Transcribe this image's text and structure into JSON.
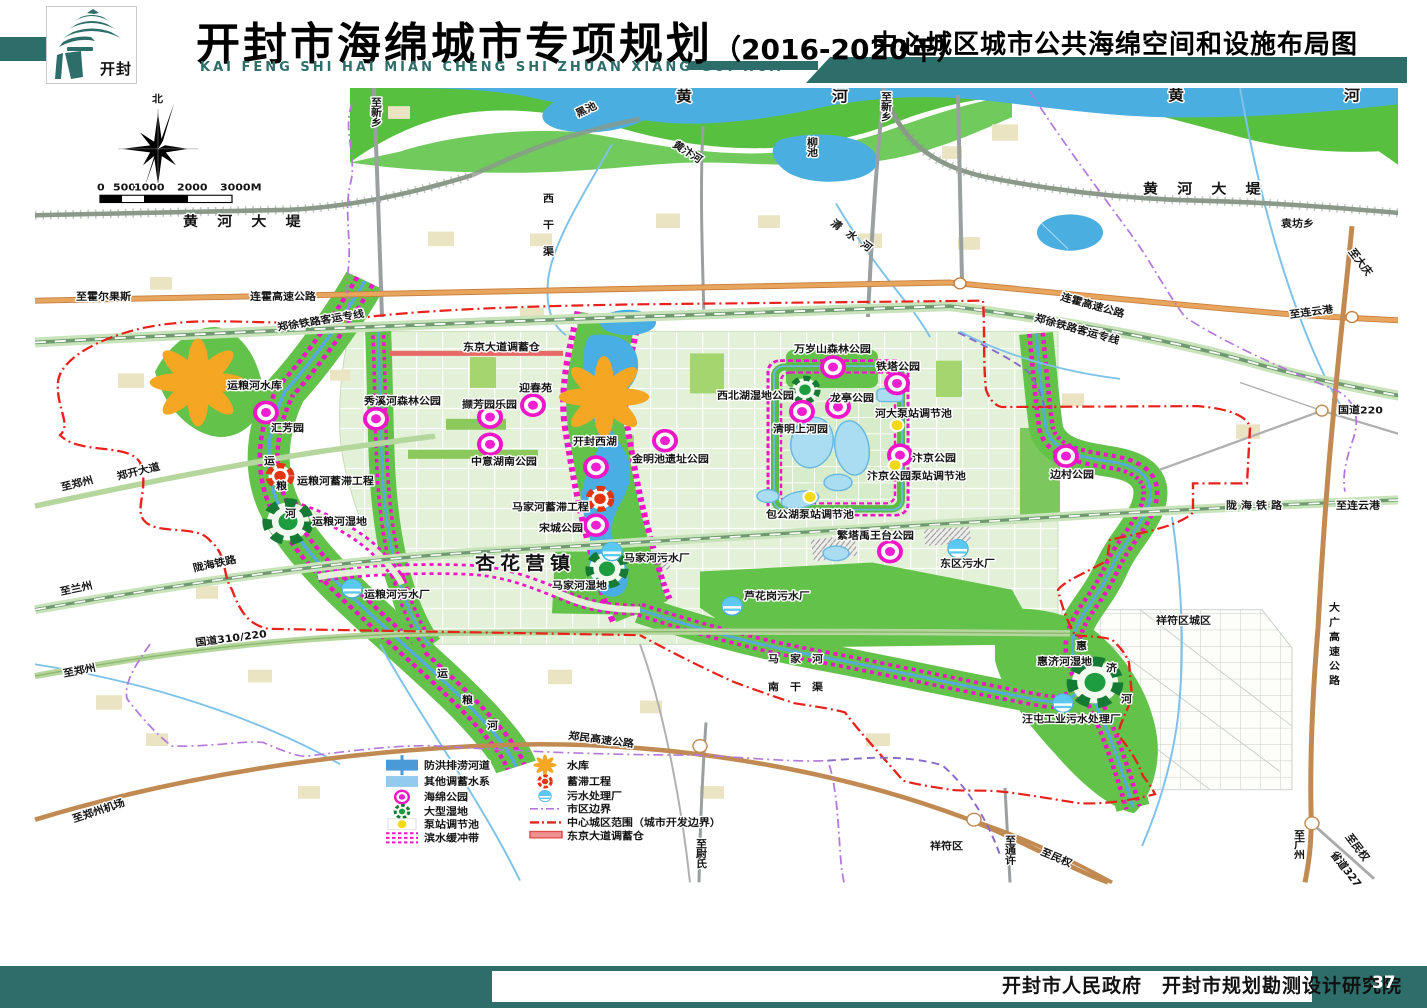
{
  "header": {
    "title": "开封市海绵城市专项规划",
    "title_year": "（2016-2020年）",
    "pinyin": "KAI FENG SHI HAI MIAN CHENG SHI ZHUAN XIANG GUI HUA",
    "subtitle": "中心城区城市公共海绵空间和设施布局图",
    "logo_seal": "开封"
  },
  "footer": {
    "credit": "开封市人民政府　开封市规划勘测设计研究院",
    "page": "37"
  },
  "compass": {
    "north": "北"
  },
  "scale_bar": {
    "labels": [
      "0",
      "500",
      "1000",
      "2000",
      "3000M"
    ]
  },
  "legend": {
    "left": [
      {
        "label": "防洪排涝河道"
      },
      {
        "label": "其他调蓄水系"
      },
      {
        "label": "海绵公园"
      },
      {
        "label": "大型湿地"
      },
      {
        "label": "泵站调节池"
      },
      {
        "label": "滨水缓冲带"
      }
    ],
    "right": [
      {
        "label": "水库"
      },
      {
        "label": "蓄滞工程"
      },
      {
        "label": "污水处理厂"
      },
      {
        "label": "市区边界"
      },
      {
        "label": "中心城区范围（城市开发边界）"
      },
      {
        "label": "东京大道调蓄仓"
      }
    ]
  },
  "colors": {
    "teal": "#2d6e6a",
    "flood_green": "#57c13f",
    "urban_green": "#e3f1d9",
    "water_blue": "#4aaee0",
    "buffer_magenta": "#ee16c8",
    "boundary_red": "#e8211a",
    "district_violet": "#b478dc",
    "highway_orange": "#e59a56",
    "highway_brown": "#c18a52"
  },
  "map": {
    "labels": [
      {
        "text": "北"
      },
      {
        "text": "黄 河 大 堤"
      },
      {
        "text": "至新乡"
      },
      {
        "text": "黑池"
      },
      {
        "text": "黄　河"
      },
      {
        "text": "黄　河"
      },
      {
        "text": "黄汴河"
      },
      {
        "text": "柳池"
      },
      {
        "text": "西干渠"
      },
      {
        "text": "至新乡"
      },
      {
        "text": "清水河"
      },
      {
        "text": "黄 河 大 堤"
      },
      {
        "text": "袁坊乡"
      },
      {
        "text": "至大庆"
      },
      {
        "text": "至霍尔果斯"
      },
      {
        "text": "连霍高速公路"
      },
      {
        "text": "郑徐铁路客运专线"
      },
      {
        "text": "连霍高速公路"
      },
      {
        "text": "郑徐铁路客运专线"
      },
      {
        "text": "至连云港"
      },
      {
        "text": "国道220"
      },
      {
        "text": "东京大道调蓄仓"
      },
      {
        "text": "运粮河水库"
      },
      {
        "text": "秀溪河森林公园"
      },
      {
        "text": "汇芳园"
      },
      {
        "text": "迎春苑"
      },
      {
        "text": "撷芳园乐园"
      },
      {
        "text": "中意湖南公园"
      },
      {
        "text": "开封西湖"
      },
      {
        "text": "金明池遗址公园"
      },
      {
        "text": "西北湖湿地公园"
      },
      {
        "text": "万岁山森林公园"
      },
      {
        "text": "铁塔公园"
      },
      {
        "text": "龙亭公园"
      },
      {
        "text": "清明上河园"
      },
      {
        "text": "河大泵站调节池"
      },
      {
        "text": "汴京公园"
      },
      {
        "text": "汴京公园泵站调节池"
      },
      {
        "text": "包公湖泵站调节池"
      },
      {
        "text": "繁塔禹王台公园"
      },
      {
        "text": "东区污水厂"
      },
      {
        "text": "边村公园"
      },
      {
        "text": "郑开大道"
      },
      {
        "text": "至郑州"
      },
      {
        "text": "运粮河蓄滞工程"
      },
      {
        "text": "运"
      },
      {
        "text": "粮"
      },
      {
        "text": "河"
      },
      {
        "text": "运粮河湿地"
      },
      {
        "text": "马家河蓄滞工程"
      },
      {
        "text": "宋城公园"
      },
      {
        "text": "陇海铁路"
      },
      {
        "text": "至兰州"
      },
      {
        "text": "国道310/220"
      },
      {
        "text": "至郑州"
      },
      {
        "text": "至郑州机场"
      },
      {
        "text": "运粮河污水厂"
      },
      {
        "text": "运"
      },
      {
        "text": "粮"
      },
      {
        "text": "河"
      },
      {
        "text": "杏花营镇"
      },
      {
        "text": "马家河污水厂"
      },
      {
        "text": "马家河湿地"
      },
      {
        "text": "芦花岗污水厂"
      },
      {
        "text": "马　家　河"
      },
      {
        "text": "南　干　渠"
      },
      {
        "text": "郑民高速公路"
      },
      {
        "text": "至尉氏"
      },
      {
        "text": "祥符区城区"
      },
      {
        "text": "陇海铁路"
      },
      {
        "text": "至连云港"
      },
      {
        "text": "大广高速公路"
      },
      {
        "text": "惠济河湿地"
      },
      {
        "text": "惠"
      },
      {
        "text": "济"
      },
      {
        "text": "河"
      },
      {
        "text": "汪屯工业污水处理厂"
      },
      {
        "text": "祥符区"
      },
      {
        "text": "至通许"
      },
      {
        "text": "至民权"
      },
      {
        "text": "至广州"
      },
      {
        "text": "至民权"
      },
      {
        "text": "省道327"
      }
    ]
  }
}
